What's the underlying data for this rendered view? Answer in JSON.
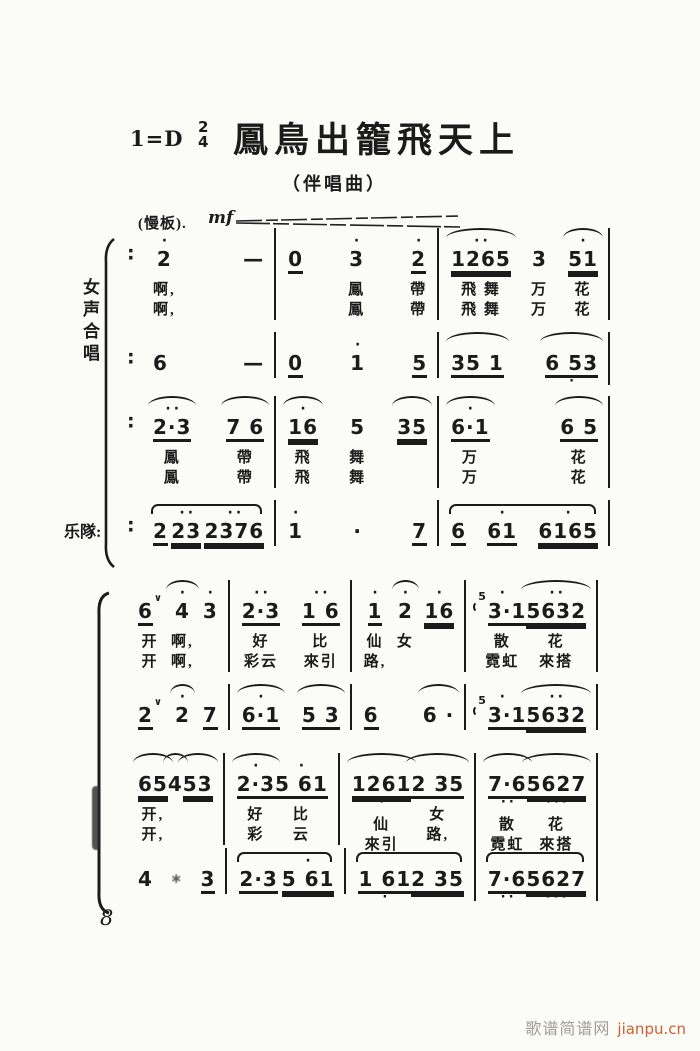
{
  "header": {
    "key": "1=D",
    "meter_top": "2",
    "meter_bottom": "4",
    "title": "鳳鳥出籠飛天上",
    "subtitle": "（伴唱曲）",
    "tempo": "(慢板).",
    "dynamic": "mf"
  },
  "labels": {
    "system1_left": "女声合唱",
    "orchestra": "乐隊:"
  },
  "ink_color": "#1b1b1b",
  "paper_color": "#fbfbf7",
  "systems": [
    {
      "lines": [
        {
          "prefix": "∶",
          "measures": [
            {
              "cols": [
                {
                  "t": "2",
                  "da": "·",
                  "lyr": [
                    "啊,",
                    "啊,"
                  ]
                },
                {
                  "t": "—"
                }
              ]
            },
            {
              "cols": [
                {
                  "t": "0",
                  "u": 1
                },
                {
                  "t": "3",
                  "da": "·",
                  "lyr": [
                    "鳳",
                    "鳳"
                  ]
                },
                {
                  "t": "2",
                  "da": "·",
                  "u": 1,
                  "lyr": [
                    "帶",
                    "帶"
                  ]
                }
              ]
            },
            {
              "cols": [
                {
                  "t": "1265",
                  "da": "··",
                  "u": 2,
                  "arc": 1,
                  "lyr": [
                    "飛 舞",
                    "飛 舞"
                  ]
                },
                {
                  "t": "3",
                  "lyr": [
                    "万",
                    "万"
                  ]
                },
                {
                  "t": "51",
                  "da": "·",
                  "u": 2,
                  "arc": 1,
                  "lyr": [
                    "花",
                    "花"
                  ]
                }
              ]
            }
          ]
        },
        {
          "prefix": "∶",
          "measures": [
            {
              "cols": [
                {
                  "t": "6"
                },
                {
                  "t": "—"
                }
              ]
            },
            {
              "cols": [
                {
                  "t": "0",
                  "u": 1
                },
                {
                  "t": "1",
                  "da": "·"
                },
                {
                  "t": "5",
                  "u": 1
                }
              ]
            },
            {
              "cols": [
                {
                  "t": "35 1",
                  "u": 1,
                  "arc": 1
                },
                {
                  "t": "6 53",
                  "db": "·",
                  "u": 1,
                  "arc": 1
                }
              ]
            }
          ]
        },
        {
          "prefix": "∶",
          "measures": [
            {
              "cols": [
                {
                  "t": "2·3",
                  "da": "··",
                  "u": 1,
                  "arc": 1,
                  "lyr": [
                    "鳳",
                    "鳳"
                  ]
                },
                {
                  "t": "7 6",
                  "u": 1,
                  "arc": 1,
                  "lyr": [
                    "帶",
                    "帶"
                  ]
                }
              ]
            },
            {
              "cols": [
                {
                  "t": "16",
                  "da": "·",
                  "u": 2,
                  "arc": 1,
                  "lyr": [
                    "飛",
                    "飛"
                  ]
                },
                {
                  "t": "5",
                  "lyr": [
                    "舞",
                    "舞"
                  ]
                },
                {
                  "t": "35",
                  "u": 2,
                  "arc": 1
                }
              ]
            },
            {
              "cols": [
                {
                  "t": "6·1",
                  "da": "·",
                  "u": 1,
                  "arc": 1,
                  "lyr": [
                    "万",
                    "万"
                  ]
                },
                {
                  "t": "6 5",
                  "u": 1,
                  "arc": 1,
                  "lyr": [
                    "花",
                    "花"
                  ]
                }
              ]
            }
          ]
        },
        {
          "prefix": "∶",
          "measures": [
            {
              "marc": 1,
              "cols": [
                {
                  "t": "2",
                  "u": 1
                },
                {
                  "t": "23",
                  "da": "··",
                  "u": 2
                },
                {
                  "t": "2376",
                  "da": "··",
                  "u": 2
                }
              ]
            },
            {
              "cols": [
                {
                  "t": "1",
                  "da": "·"
                },
                {
                  "t": "·"
                },
                {
                  "t": "7",
                  "u": 1
                }
              ]
            },
            {
              "marc": 1,
              "cols": [
                {
                  "t": "6",
                  "u": 1
                },
                {
                  "t": "61",
                  "da": "·",
                  "u": 1
                },
                {
                  "t": "6165",
                  "da": "·",
                  "u": 2
                }
              ]
            }
          ]
        }
      ]
    },
    {
      "lines": [
        {
          "measures": [
            {
              "cols": [
                {
                  "t": "6",
                  "u": 1,
                  "breath": 1,
                  "lyr": [
                    "开",
                    "开"
                  ]
                },
                {
                  "t": "4",
                  "da": "·",
                  "arc": 1,
                  "lyr": [
                    "啊,",
                    "啊,"
                  ]
                },
                {
                  "t": "3",
                  "da": "·"
                }
              ]
            },
            {
              "cols": [
                {
                  "t": "2·3",
                  "da": "··",
                  "u": 1,
                  "lyr": [
                    "好",
                    "彩云"
                  ]
                },
                {
                  "t": "1 6",
                  "da": "··",
                  "u": 1,
                  "lyr": [
                    "比",
                    "來引"
                  ]
                }
              ]
            },
            {
              "cols": [
                {
                  "t": "1",
                  "da": "·",
                  "u": 1,
                  "lyr": [
                    "仙",
                    "路,"
                  ]
                },
                {
                  "t": "2",
                  "da": "·",
                  "arc": 1,
                  "lyr": [
                    "女",
                    ""
                  ]
                },
                {
                  "t": "16",
                  "da": "·",
                  "u": 2
                }
              ]
            },
            {
              "cols": [
                {
                  "sup": "5",
                  "t": "3·1",
                  "da": "·",
                  "u": 1,
                  "lyr": [
                    "散",
                    "霓虹"
                  ]
                },
                {
                  "t": "5632",
                  "da": "··",
                  "u": 2,
                  "arc": 1,
                  "lyr": [
                    "花",
                    "來搭"
                  ]
                }
              ]
            }
          ]
        },
        {
          "measures": [
            {
              "cols": [
                {
                  "t": "2",
                  "u": 1,
                  "breath": 1
                },
                {
                  "t": "2",
                  "da": "·",
                  "arc": 1
                },
                {
                  "t": "7",
                  "u": 1
                }
              ]
            },
            {
              "cols": [
                {
                  "t": "6·1",
                  "da": "·",
                  "u": 1,
                  "arc": 1
                },
                {
                  "t": "5 3",
                  "u": 1,
                  "arc": 1
                }
              ]
            },
            {
              "cols": [
                {
                  "t": "6",
                  "u": 1
                },
                {
                  "t": "6 ·",
                  "arc": 1
                }
              ]
            },
            {
              "cols": [
                {
                  "sup": "5",
                  "t": "3·1",
                  "da": "·",
                  "u": 1
                },
                {
                  "t": "5632",
                  "da": "··",
                  "u": 2,
                  "arc": 1
                }
              ]
            }
          ]
        },
        {
          "measures": [
            {
              "cols": [
                {
                  "t": "65",
                  "u": 2,
                  "arc": 1,
                  "lyr": [
                    "开,",
                    "开,"
                  ]
                },
                {
                  "t": "4",
                  "arc": 1
                },
                {
                  "t": "53",
                  "u": 2,
                  "arc": 1
                }
              ]
            },
            {
              "cols": [
                {
                  "t": "2·3",
                  "da": "·",
                  "u": 1,
                  "arc": 1,
                  "lyr": [
                    "好",
                    "彩"
                  ]
                },
                {
                  "t": "5 61",
                  "da": "·",
                  "u": 1,
                  "lyr": [
                    "比",
                    "云"
                  ]
                }
              ]
            },
            {
              "cols": [
                {
                  "t": "1261",
                  "u": 2,
                  "arc": 1,
                  "db": "·",
                  "lyr": [
                    "仙",
                    "來引"
                  ]
                },
                {
                  "t": "2 35",
                  "u": 1,
                  "arc": 1,
                  "lyr": [
                    "女",
                    "路,"
                  ]
                }
              ]
            },
            {
              "cols": [
                {
                  "t": "7·6",
                  "db": "··",
                  "u": 1,
                  "arc": 1,
                  "lyr": [
                    "散",
                    "霓虹"
                  ]
                },
                {
                  "t": "5627",
                  "db": "···",
                  "u": 2,
                  "arc": 1,
                  "lyr": [
                    "花",
                    "來搭"
                  ]
                }
              ]
            }
          ]
        },
        {
          "measures": [
            {
              "cols": [
                {
                  "t": "4"
                },
                {
                  "t": "∗",
                  "cls": "smudge"
                },
                {
                  "t": "3",
                  "u": 1
                }
              ]
            },
            {
              "marc": 1,
              "cols": [
                {
                  "t": "2·3",
                  "u": 1
                },
                {
                  "t": "5 61",
                  "da": "·",
                  "u": 2
                }
              ]
            },
            {
              "marc": 1,
              "cols": [
                {
                  "t": "1 61",
                  "u": 1,
                  "db": "·"
                },
                {
                  "t": "2 35",
                  "u": 2
                }
              ]
            },
            {
              "marc": 1,
              "cols": [
                {
                  "t": "7·6",
                  "db": "··",
                  "u": 1
                },
                {
                  "t": "5627",
                  "db": "···",
                  "u": 2
                }
              ]
            }
          ]
        }
      ]
    }
  ],
  "footer": {
    "page_number": "8"
  },
  "watermark": {
    "site": "歌谱简谱网",
    "url_text": "jianpu.cn",
    "site_color": "#a39d95",
    "url_color": "#cf5f2f"
  }
}
